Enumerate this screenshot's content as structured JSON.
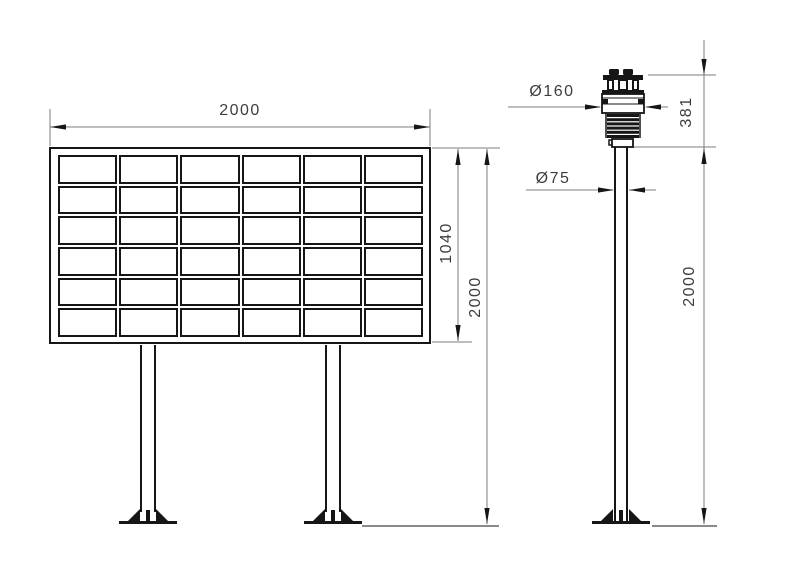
{
  "figure": {
    "type": "technical-drawing",
    "background": "#ffffff",
    "line_color": "#161616",
    "dim_line_color": "#7d7d7d",
    "text_color": "#3d3d3d"
  },
  "views": {
    "display_board": {
      "label": "display board front view",
      "grid_rows": 6,
      "grid_cols": 6,
      "width_dim": "2000",
      "screen_height_dim": "1040",
      "overall_height_dim": "2000"
    },
    "sensor_pole": {
      "label": "weather sensor pole side view",
      "sensor_diameter_dim": "Ø160",
      "sensor_height_dim": "381",
      "pole_diameter_dim": "Ø75",
      "pole_height_dim": "2000"
    }
  }
}
